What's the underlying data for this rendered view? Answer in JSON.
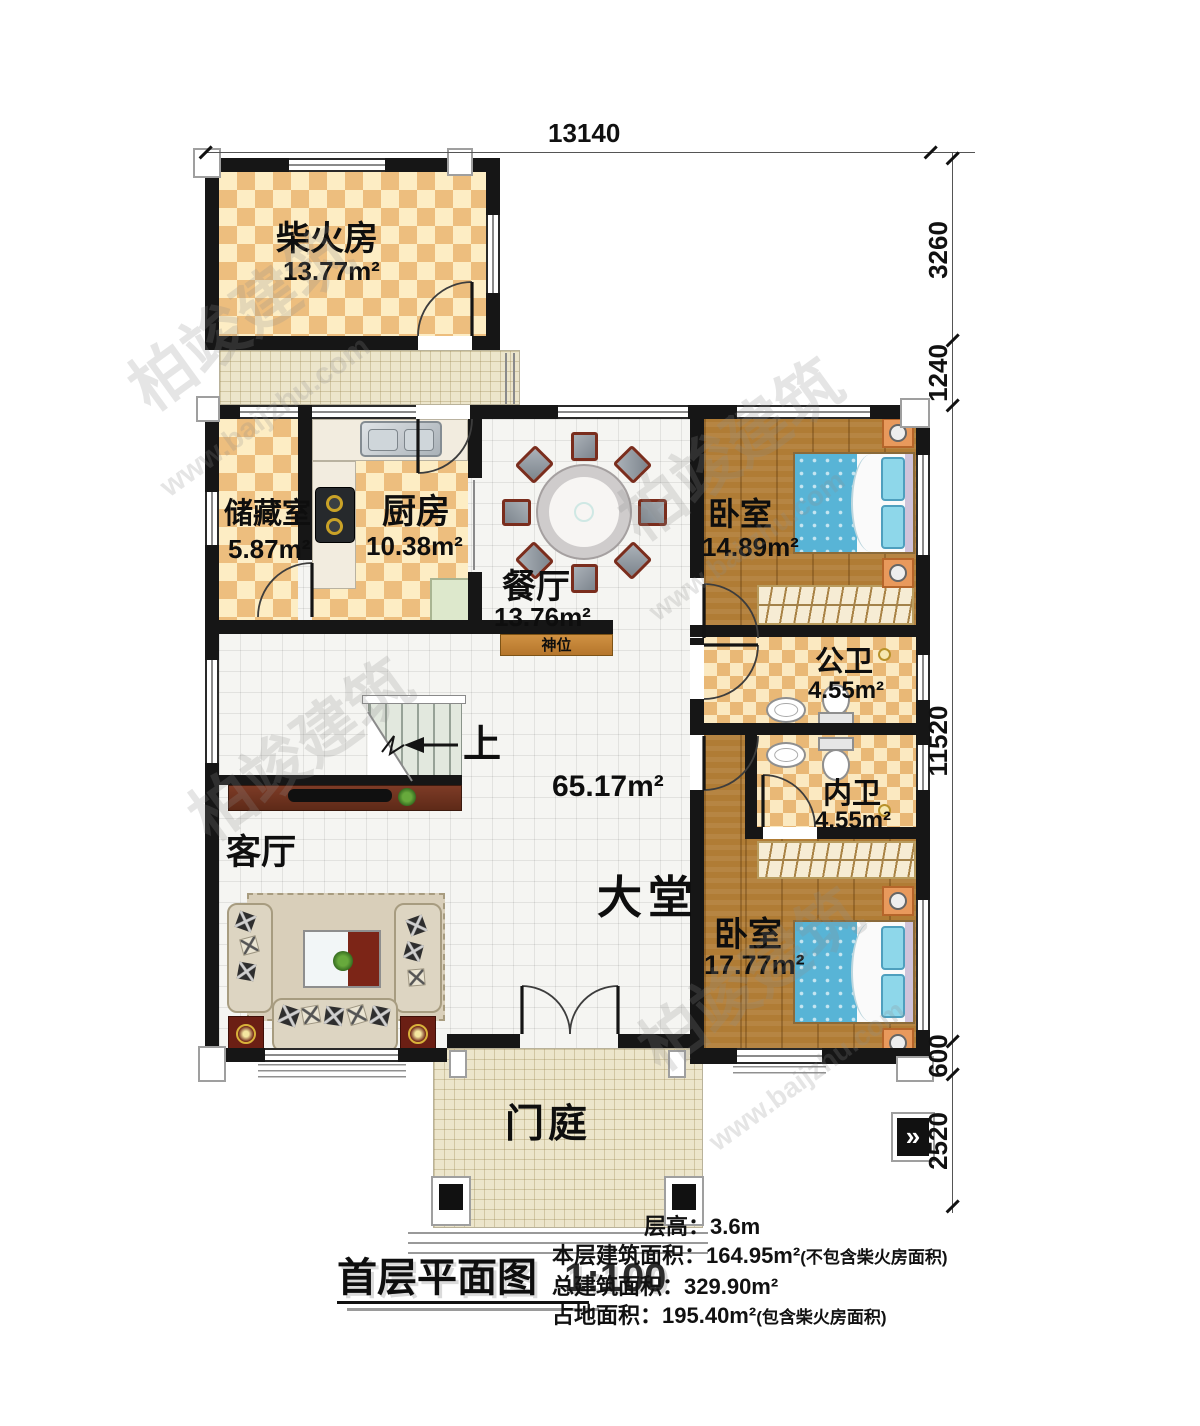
{
  "watermark": {
    "brand": "柏竣建筑",
    "site": "www.baijzhu.com"
  },
  "dims": {
    "top": "13140",
    "r1": "3260",
    "r2": "1240",
    "r3": "11520",
    "r4": "600",
    "r5": "2520"
  },
  "rooms": {
    "firewood": {
      "name": "柴火房",
      "area": "13.77m²"
    },
    "storage": {
      "name": "储藏室",
      "area": "5.87m²"
    },
    "kitchen": {
      "name": "厨房",
      "area": "10.38m²"
    },
    "dining": {
      "name": "餐厅",
      "area": "13.76m²"
    },
    "bedroom1": {
      "name": "卧室",
      "area": "14.89m²"
    },
    "public_bath": {
      "name": "公卫",
      "area": "4.55m²"
    },
    "private_bath": {
      "name": "内卫",
      "area": "4.55m²"
    },
    "bedroom2": {
      "name": "卧室",
      "area": "17.77m²"
    },
    "living": {
      "name": "客厅"
    },
    "hall": {
      "name": "大堂",
      "area": "65.17m²"
    },
    "porch": {
      "name": "门庭"
    }
  },
  "annotations": {
    "shrine": "神位",
    "stairs_up": "上"
  },
  "footer": {
    "title": "首层平面图",
    "scale": "1:100",
    "line1_label": "层高：",
    "line1_value": "3.6m",
    "line2_label": "本层建筑面积：",
    "line2_value": "164.95m²",
    "line2_note": "(不包含柴火房面积)",
    "line3_label": "总建筑面积：",
    "line3_value": "329.90m²",
    "line4_label": "占地面积：",
    "line4_value": "195.40m²",
    "line4_note": "(包含柴火房面积)"
  }
}
